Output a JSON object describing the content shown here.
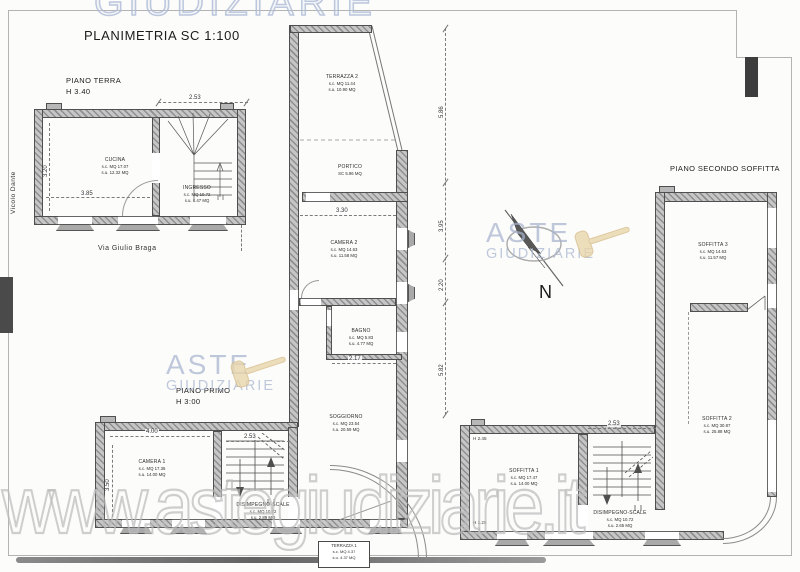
{
  "title": "PLANIMETRIA SC 1:100",
  "north_label": "N",
  "streets": {
    "left": "Vicolo Dante",
    "bottom": "Via Giulio Braga"
  },
  "floors": {
    "terra": {
      "name": "PIANO TERRA",
      "height": "H 3.40"
    },
    "primo": {
      "name": "PIANO PRIMO",
      "height": "H 3:00"
    },
    "secondo": {
      "name": "PIANO SECONDO SOFFITTA"
    }
  },
  "rooms": {
    "cucina": {
      "name": "CUCINA",
      "sc": "s.c. MQ 17.07",
      "su": "s.u. 12.32 MQ"
    },
    "ingresso": {
      "name": "INGRESSO",
      "sc": "s.c. MQ 10.72",
      "su": "s.u. 8.47 MQ"
    },
    "terrazza2": {
      "name": "TERRAZZA 2",
      "sc": "s.c. MQ 11.44",
      "su": "s.u. 10.90 MQ"
    },
    "portico": {
      "name": "PORTICO",
      "sc": "SC 5.96 MQ"
    },
    "camera2": {
      "name": "CAMERA 2",
      "sc": "s.c. MQ 14.63",
      "su": "s.u. 11.58 MQ"
    },
    "bagno": {
      "name": "BAGNO",
      "sc": "s.c. MQ 5.83",
      "su": "s.u. 4.77 MQ"
    },
    "soggiorno": {
      "name": "SOGGIORNO",
      "sc": "s.c. MQ 23.54",
      "su": "s.u. 20.59 MQ"
    },
    "camera1": {
      "name": "CAMERA 1",
      "sc": "s.c. MQ 17.36",
      "su": "s.u. 14.00 MQ"
    },
    "disimpegno1": {
      "name": "DISIMPEGNO-SCALE",
      "sc": "s.c. MQ 10.72",
      "su": "s.u. 2.89 MQ"
    },
    "terrazza1": {
      "name": "TERRAZZA 1",
      "sc": "s.c. MQ 4.37",
      "su": "s.u. 4.37 MQ"
    },
    "soffitta3": {
      "name": "SOFFITTA 3",
      "sc": "s.c. MQ 14.63",
      "su": "s.u. 11.57 MQ"
    },
    "soffitta2": {
      "name": "SOFFITTA 2",
      "sc": "s.c. MQ 30.87",
      "su": "s.u. 25.88 MQ"
    },
    "soffitta1": {
      "name": "SOFFITTA 1",
      "sc": "s.c. MQ 17.47",
      "su": "s.u. 14.00 MQ"
    },
    "disimpegno2": {
      "name": "DISIMPEGNO-SCALE",
      "sc": "s.c. MQ 10.72",
      "su": "s.u. 2.65 MQ"
    }
  },
  "dimensions": {
    "terra_top": "2.53",
    "terra_depth": "3.20",
    "terra_width": "3.85",
    "portico_width": "3.30",
    "bagno_width": "2.17",
    "chain": [
      "5.86",
      "3.95",
      "2.20",
      "5.82"
    ],
    "camera1_width": "4.00",
    "camera1_depth": "3.50",
    "primo_stairs_width": "2.53",
    "soffitta_stairs_width": "2.53",
    "soffitta1_h_top": "H 2.45",
    "soffitta1_h_bottom": "H 1.25"
  },
  "watermarks": {
    "top_text": "GIUDIZIARIE",
    "logo_line1": "ASTE",
    "logo_line2": "GIUDIZIARIE",
    "url": "www.astegiudiziarie.it"
  },
  "colors": {
    "watermark_blue": "#a8b4ce",
    "wall_gray": "#b5b5b5",
    "gavel_tan": "#e9d6ac"
  }
}
